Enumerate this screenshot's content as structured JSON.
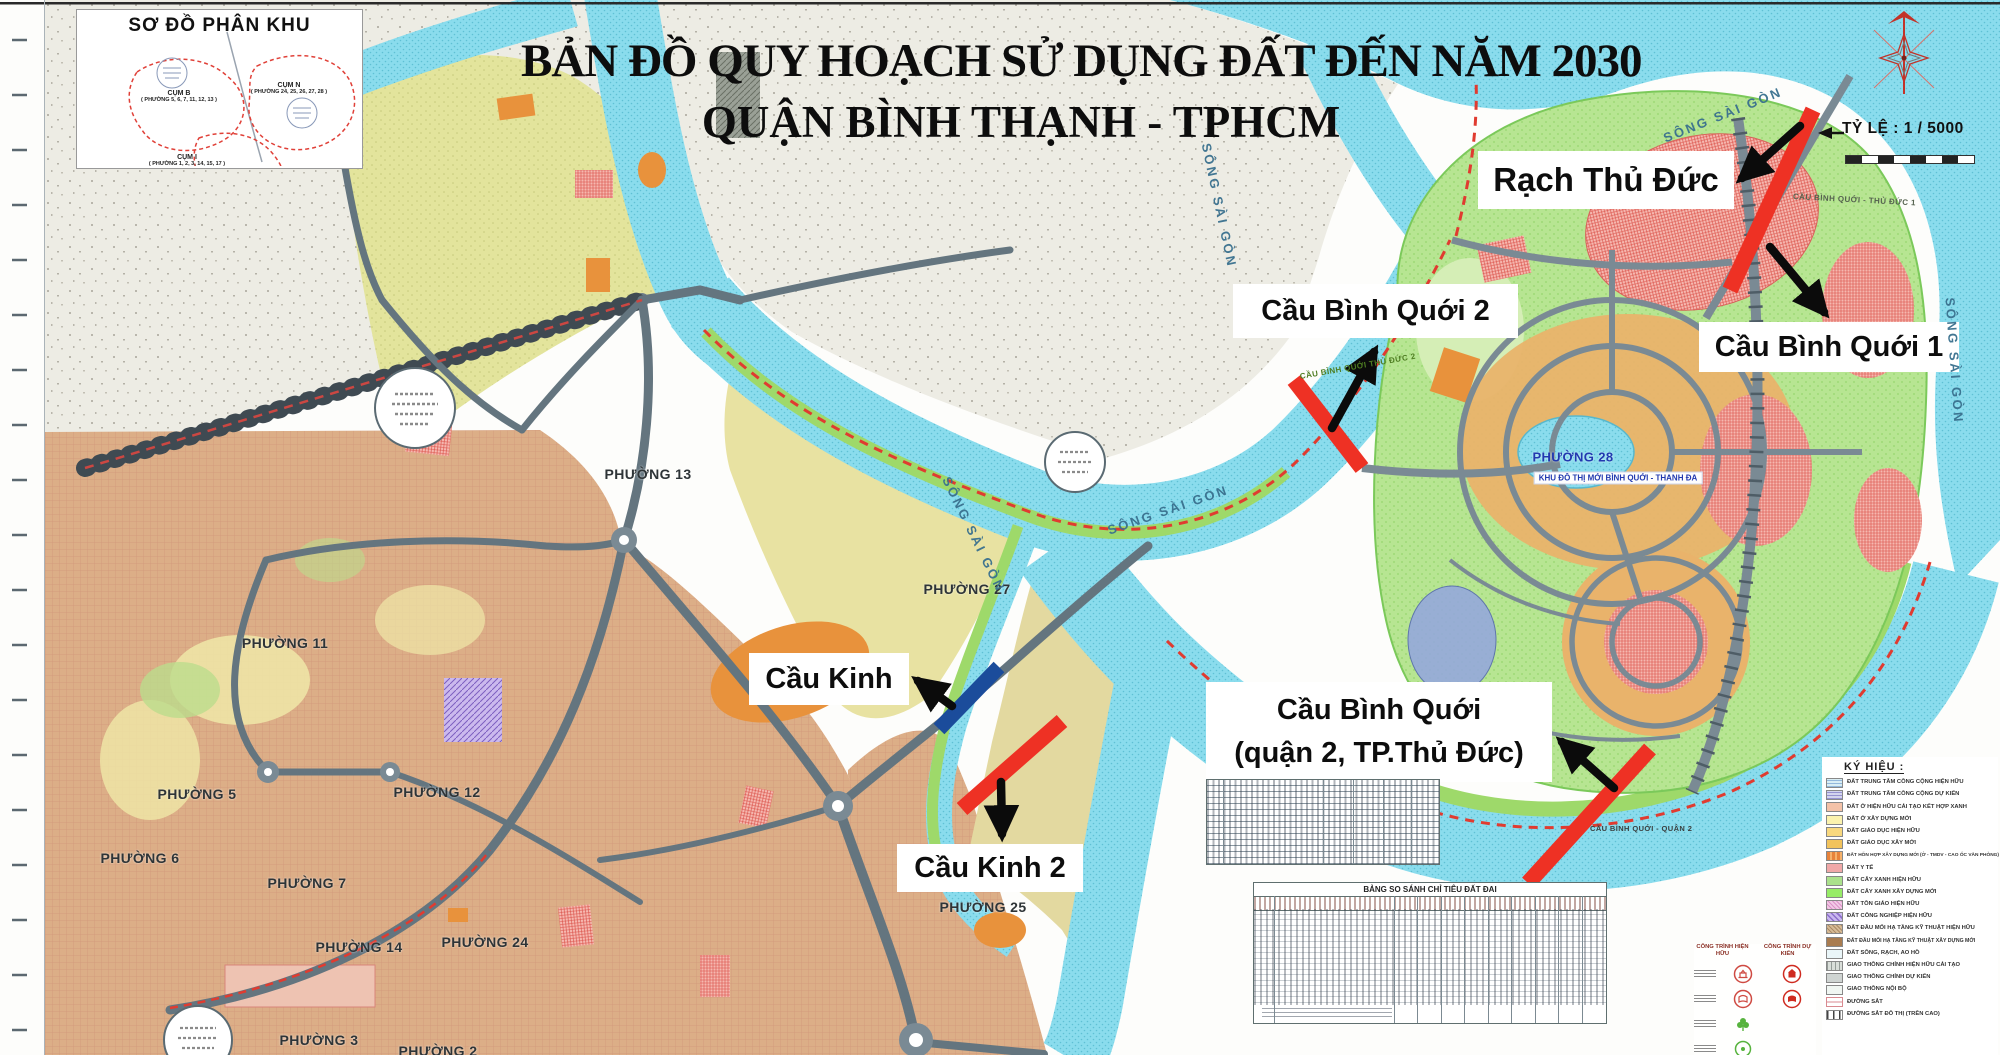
{
  "title": {
    "line1": "BẢN ĐỒ QUY HOẠCH SỬ DỤNG ĐẤT ĐẾN NĂM 2030",
    "line2": "QUẬN BÌNH THẠNH - TPHCM"
  },
  "inset": {
    "title": "SƠ ĐỒ PHÂN KHU",
    "clusters": [
      {
        "name": "CỤM B",
        "wards": "( PHƯỜNG 5, 6, 7, 11, 12, 13 )"
      },
      {
        "name": "CỤM N",
        "wards": "( PHƯỜNG 24, 25, 26, 27, 28 )"
      },
      {
        "name": "CỤM I",
        "wards": "( PHƯỜNG 1, 2, 3, 14, 15, 17 )"
      }
    ]
  },
  "scale": {
    "label": "TỶ LỆ : 1 / 5000"
  },
  "callouts": {
    "rach_thu_duc": "Rạch Thủ Đức",
    "cbq1": "Cầu Bình Quới 1",
    "cbq2": "Cầu Bình Quới 2",
    "cau_kinh": "Cầu Kinh",
    "cau_kinh_2": "Cầu Kinh 2",
    "cbq_q2_line1": "Cầu Bình Quới",
    "cbq_q2_line2": "(quận 2, TP.Thủ Đức)"
  },
  "wards": [
    "PHƯỜNG 13",
    "PHƯỜNG 11",
    "PHƯỜNG 5",
    "PHƯỜNG 6",
    "PHƯỜNG 7",
    "PHƯỜNG 12",
    "PHƯỜNG 14",
    "PHƯỜNG 24",
    "PHƯỜNG 3",
    "PHƯỜNG 2",
    "PHƯỜNG 25",
    "PHƯỜNG 27",
    "PHƯỜNG 28"
  ],
  "map_texts": {
    "song_sai_gon": "SÔNG SÀI GÒN",
    "khu_do_thi": "KHU ĐÔ THỊ MỚI BÌNH QUỚI - THANH ĐA",
    "cau_bq_td1": "CẦU BÌNH QUỚI - THỦ ĐỨC 1",
    "cau_bq_td2": "CẦU BÌNH QUỚI THỦ ĐỨC 2",
    "cau_bq_q2": "CẦU BÌNH QUỚI - QUẬN 2"
  },
  "legend": {
    "title": "KÝ HIỆU :",
    "existing_col": "CÔNG TRÌNH HIỆN HỮU",
    "planned_col": "CÔNG TRÌNH DỰ KIẾN",
    "items": [
      "ĐẤT TRUNG TÂM CÔNG CỘNG HIỆN HỮU",
      "ĐẤT TRUNG TÂM CÔNG CỘNG DỰ KIẾN",
      "ĐẤT Ở HIỆN HỮU CẢI TẠO KẾT HỢP XANH",
      "ĐẤT Ở XÂY DỰNG MỚI",
      "ĐẤT GIÁO DỤC HIỆN HỮU",
      "ĐẤT GIÁO DỤC XÂY MỚI",
      "ĐẤT HỖN HỢP XÂY DỰNG MỚI (Ở - TMDV - CAO ỐC VĂN PHÒNG)",
      "ĐẤT Y TẾ",
      "ĐẤT CÂY XANH HIỆN HỮU",
      "ĐẤT CÂY XANH XÂY DỰNG MỚI",
      "ĐẤT TÔN GIÁO HIỆN HỮU",
      "ĐẤT CÔNG NGHIỆP HIỆN HỮU",
      "ĐẤT ĐẦU MỐI HẠ TẦNG KỸ THUẬT HIỆN HỮU",
      "ĐẤT ĐẦU MỐI HẠ TẦNG KỸ THUẬT XÂY DỰNG MỚI",
      "ĐẤT SÔNG, RẠCH, AO HỒ",
      "GIAO THÔNG CHÍNH HIỆN HỮU CẢI TẠO",
      "GIAO THÔNG CHÍNH DỰ KIẾN",
      "GIAO THÔNG NỘI BỘ",
      "ĐƯỜNG SẮT",
      "ĐƯỜNG SẮT ĐÔ THỊ (TRÊN CAO)"
    ]
  },
  "tables": {
    "compare_title": "BẢNG SO SÁNH CHỈ TIÊU ĐẤT ĐAI"
  },
  "colors": {
    "bridge_red": "#ee3124",
    "bridge_blue": "#1b4c9b",
    "annotation_black": "#0b0b0b",
    "river": "#8adced",
    "peninsula_green": "#b7e592",
    "land_tan": "#dcae87",
    "road_gray": "#64757f",
    "compass_red": "#c23329"
  }
}
